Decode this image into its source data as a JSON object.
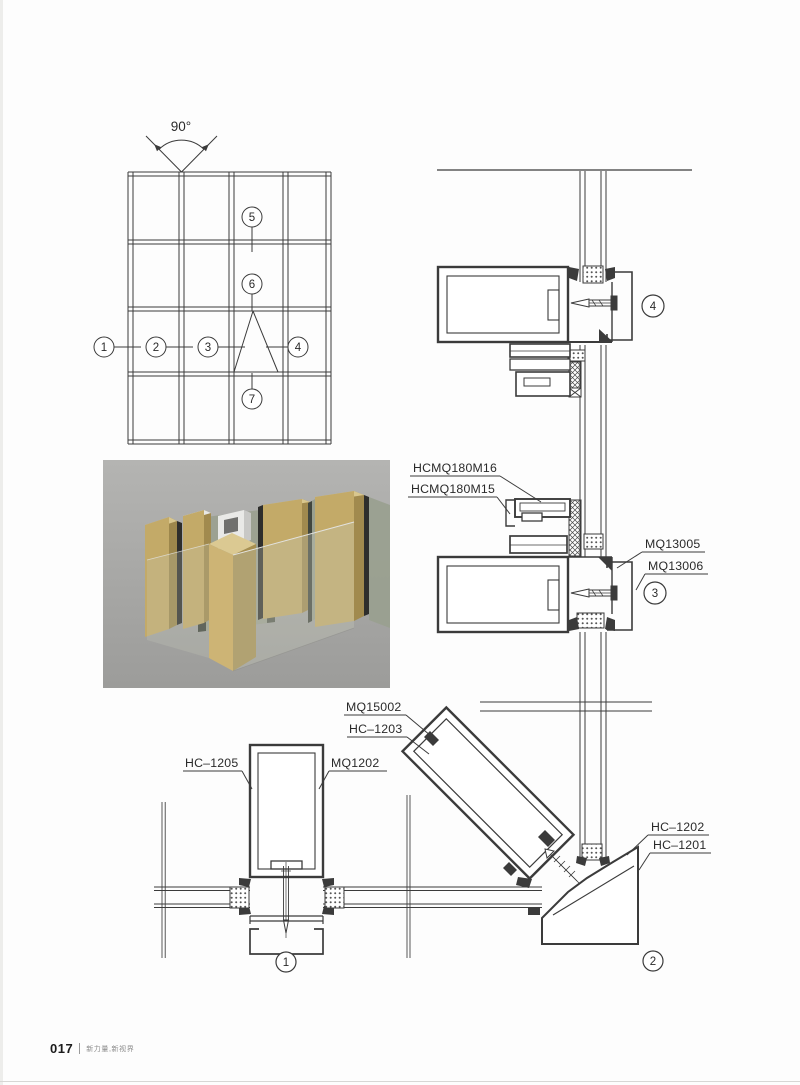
{
  "page": {
    "number": "017",
    "tagline": "新力量,新视界"
  },
  "colors": {
    "line": "#3b3b3b",
    "label_text": "#2a2a2a",
    "render_background": "#a8a8a6",
    "profile_gold": "#c3aa68",
    "glass_green": "#9aa08f"
  },
  "elevation": {
    "angle_label": "90°",
    "callouts": [
      "1",
      "2",
      "3",
      "4",
      "5",
      "6",
      "7"
    ]
  },
  "sections": {
    "detail1": {
      "callout": "1",
      "labels": {
        "left": "HC–1205",
        "right": "MQ1202"
      }
    },
    "detail2": {
      "callout": "2",
      "labels": {
        "diagonal_outer": "MQ15002",
        "diagonal_inner": "HC–1203",
        "corner_upper": "HC–1202",
        "corner_lower": "HC–1201"
      }
    },
    "detail3": {
      "callout": "3",
      "labels": {
        "vent_upper": "HCMQ180M16",
        "vent_lower": "HCMQ180M15",
        "cap_upper": "MQ13005",
        "cap_lower": "MQ13006"
      }
    },
    "detail4": {
      "callout": "4"
    }
  }
}
